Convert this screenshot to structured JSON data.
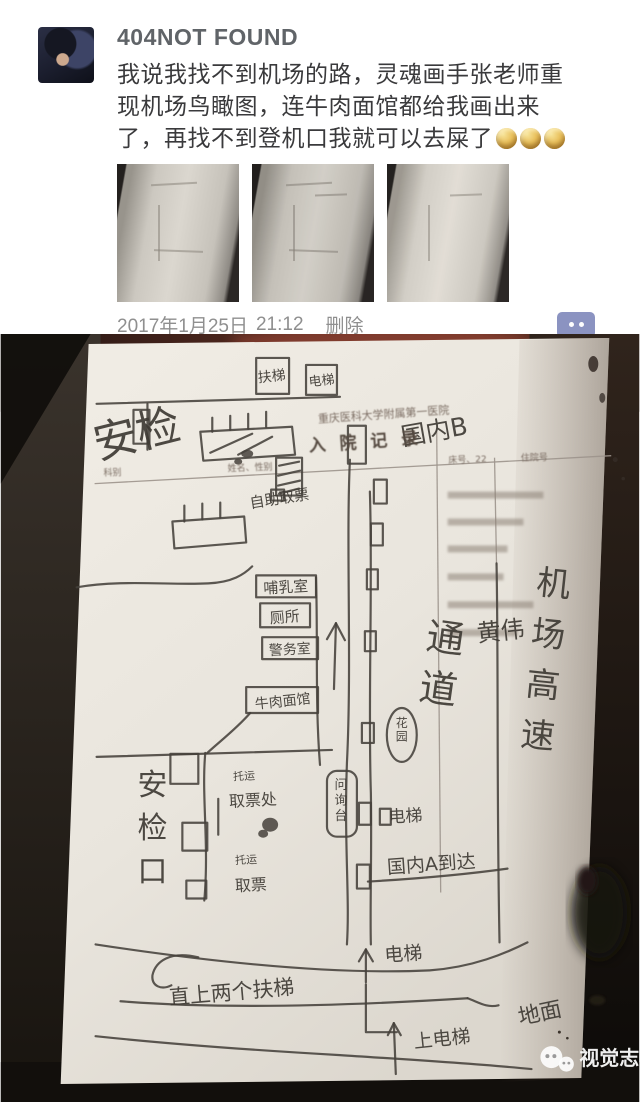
{
  "post": {
    "username": "404NOT FOUND",
    "body": "我说我找不到机场的路，灵魂画手张老师重现机场鸟瞰图，连牛肉面馆都给我画出来了，再找不到登机口我就可以去屎了",
    "emoji_count": 3,
    "emoji_name": "gold-moon-face-emoji",
    "date": "2017年1月25日",
    "time": "21:12",
    "delete_label": "删除",
    "thumbnail_count": 3
  },
  "watermark": {
    "brand": "视觉志"
  },
  "colors": {
    "username_gray": "#606468",
    "body_text": "#3a3a3c",
    "meta_gray": "#8f8f8f",
    "comment_button_blue": "#8b93c1",
    "emoji_gold": "#e9c05c",
    "pen_ink": "#45413b",
    "paper": "#ece8e0"
  },
  "map": {
    "description": "hand-drawn airport bird's-eye map on a hospital admission form",
    "labels": [
      {
        "t": "扶梯",
        "x": 272,
        "y": 47,
        "s": 14,
        "r": -6,
        "c": "pen-t"
      },
      {
        "t": "电梯",
        "x": 322,
        "y": 51,
        "s": 13,
        "r": -6,
        "c": "pen-t"
      },
      {
        "t": "安检",
        "x": 140,
        "y": 115,
        "s": 44,
        "r": -14,
        "c": "pen-t"
      },
      {
        "t": "国内B",
        "x": 436,
        "y": 106,
        "s": 25,
        "r": -10,
        "c": "pen-t"
      },
      {
        "t": "自助取票",
        "x": 280,
        "y": 170,
        "s": 15,
        "r": -9,
        "c": "pen-t"
      },
      {
        "t": "哺乳室",
        "x": 286,
        "y": 259,
        "s": 15,
        "r": -3,
        "c": "pen-t"
      },
      {
        "t": "厕所",
        "x": 285,
        "y": 289,
        "s": 15,
        "r": -5,
        "c": "pen-t"
      },
      {
        "t": "警务室",
        "x": 290,
        "y": 321,
        "s": 14,
        "r": -3,
        "c": "pen-t"
      },
      {
        "t": "牛肉面馆",
        "x": 283,
        "y": 373,
        "s": 14,
        "r": -6,
        "c": "pen-t"
      },
      {
        "t": "通道",
        "x": 444,
        "y": 318,
        "s": 38,
        "r": 8,
        "v": 1,
        "g": 1.35,
        "c": "pen-t"
      },
      {
        "t": "黄伟",
        "x": 502,
        "y": 306,
        "s": 24,
        "r": -6,
        "c": "pen-t"
      },
      {
        "t": "机场高速",
        "x": 553,
        "y": 262,
        "s": 34,
        "r": 6,
        "v": 1,
        "g": 1.5,
        "c": "pen-t"
      },
      {
        "t": "花园",
        "x": 402,
        "y": 394,
        "s": 12,
        "r": 0,
        "v": 1,
        "g": 1.15,
        "c": "pen-t"
      },
      {
        "t": "问询台",
        "x": 341,
        "y": 456,
        "s": 13,
        "r": 0,
        "v": 1,
        "g": 1.2,
        "c": "pen-t"
      },
      {
        "t": "电梯",
        "x": 406,
        "y": 489,
        "s": 17,
        "r": -3,
        "c": "pen-t"
      },
      {
        "t": "国内A到达",
        "x": 432,
        "y": 538,
        "s": 19,
        "r": -4,
        "c": "pen-t"
      },
      {
        "t": "安检口",
        "x": 152,
        "y": 462,
        "s": 30,
        "r": 0,
        "v": 1,
        "g": 1.45,
        "c": "pen-t"
      },
      {
        "t": "托运",
        "x": 244,
        "y": 447,
        "s": 11,
        "r": -3,
        "c": "pen-t"
      },
      {
        "t": "取票处",
        "x": 253,
        "y": 473,
        "s": 16,
        "r": -3,
        "c": "pen-t"
      },
      {
        "t": "托运",
        "x": 246,
        "y": 531,
        "s": 11,
        "r": -3,
        "c": "pen-t"
      },
      {
        "t": "取票",
        "x": 251,
        "y": 558,
        "s": 16,
        "r": -3,
        "c": "pen-t"
      },
      {
        "t": "直上两个扶梯",
        "x": 232,
        "y": 667,
        "s": 21,
        "r": -5,
        "c": "pen-t"
      },
      {
        "t": "电梯",
        "x": 404,
        "y": 628,
        "s": 19,
        "r": -4,
        "c": "pen-t"
      },
      {
        "t": "地面",
        "x": 542,
        "y": 688,
        "s": 22,
        "r": -12,
        "c": "pen-t"
      },
      {
        "t": "上电梯",
        "x": 443,
        "y": 713,
        "s": 19,
        "r": -6,
        "c": "pen-t"
      },
      {
        "t": "重庆医科大学附属第一医院",
        "x": 384,
        "y": 84,
        "s": 11,
        "r": -4,
        "c": "print"
      },
      {
        "t": "入 院 记 录",
        "x": 366,
        "y": 114,
        "s": 17,
        "r": -4,
        "c": "printbold"
      },
      {
        "t": "科别",
        "x": 112,
        "y": 142,
        "s": 9,
        "r": -2,
        "c": "print"
      },
      {
        "t": "姓名、性别",
        "x": 250,
        "y": 137,
        "s": 9,
        "r": -2,
        "c": "print"
      },
      {
        "t": "床号、22",
        "x": 468,
        "y": 129,
        "s": 9,
        "r": -2,
        "c": "print"
      },
      {
        "t": "住院号",
        "x": 535,
        "y": 127,
        "s": 9,
        "r": -2,
        "c": "print"
      }
    ]
  }
}
